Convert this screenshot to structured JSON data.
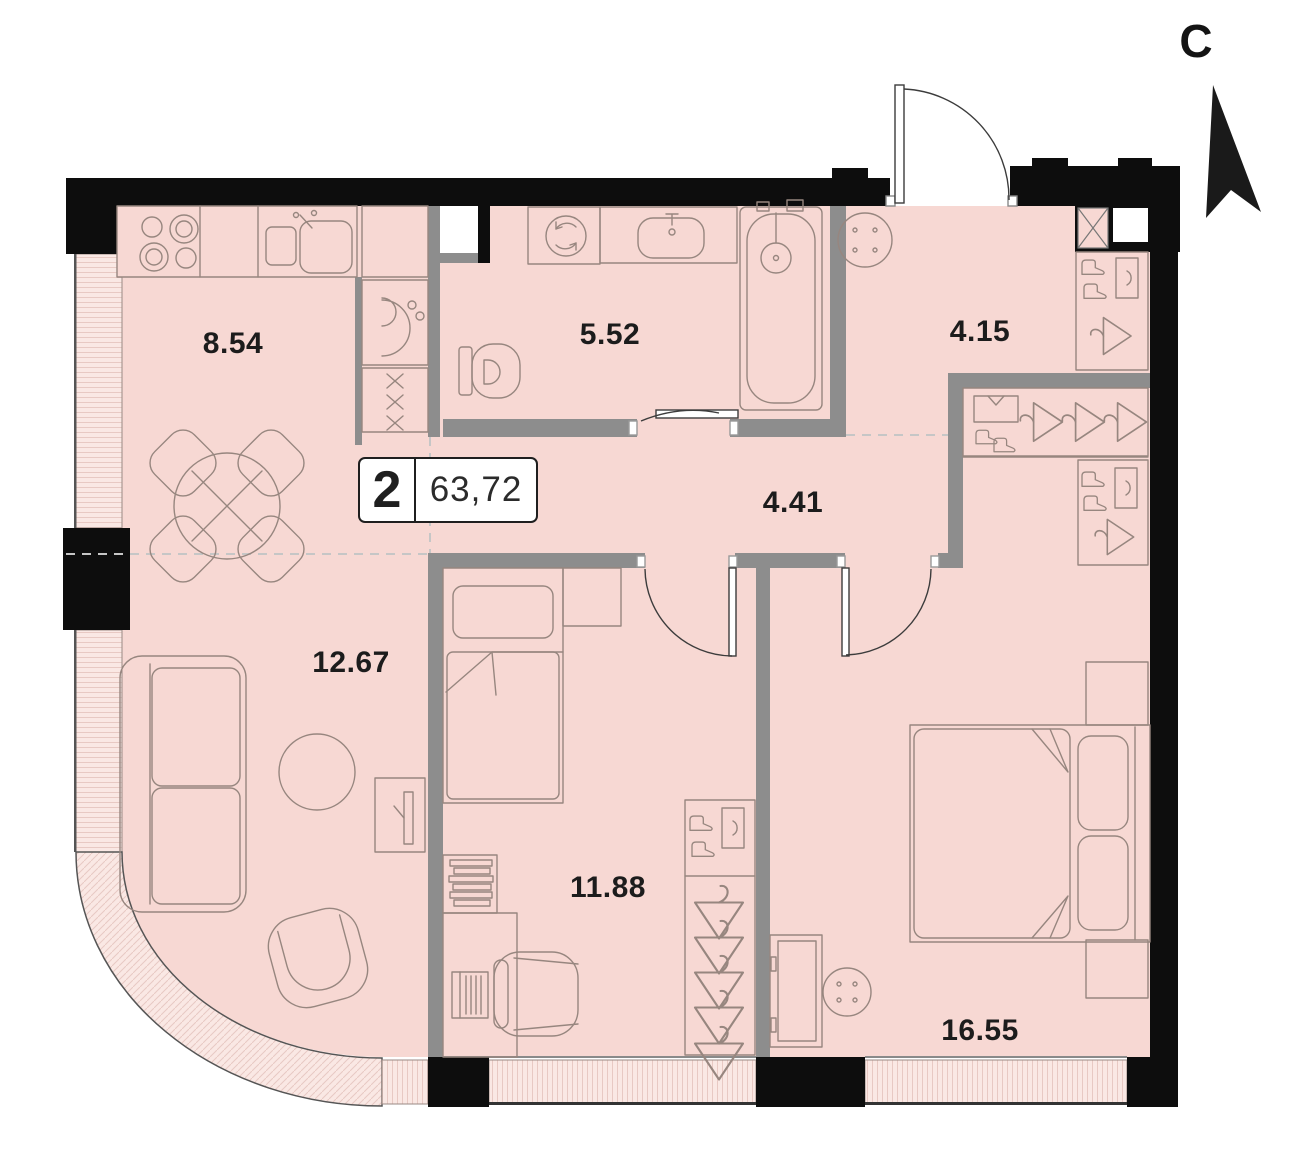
{
  "plan": {
    "badge": {
      "rooms_count": "2",
      "total_area": "63,72"
    },
    "north_label": "С",
    "rooms": [
      {
        "name": "kitchen",
        "area": "8.54"
      },
      {
        "name": "bathroom",
        "area": "5.52"
      },
      {
        "name": "hallway",
        "area": "4.15"
      },
      {
        "name": "corridor",
        "area": "4.41"
      },
      {
        "name": "living-room",
        "area": "12.67"
      },
      {
        "name": "bedroom",
        "area": "11.88"
      },
      {
        "name": "master-bedroom",
        "area": "16.55"
      }
    ]
  },
  "colors": {
    "floor": "#f7d8d3",
    "window": "#fae8e4",
    "window_line": "#e8c9c3",
    "wall_black": "#0d0d0d",
    "wall_gray": "#8d8d8d",
    "line": "#97867f",
    "door_line": "#3c3c3c",
    "dash": "#c6c6c6",
    "label_color": "#1c1c1c"
  }
}
